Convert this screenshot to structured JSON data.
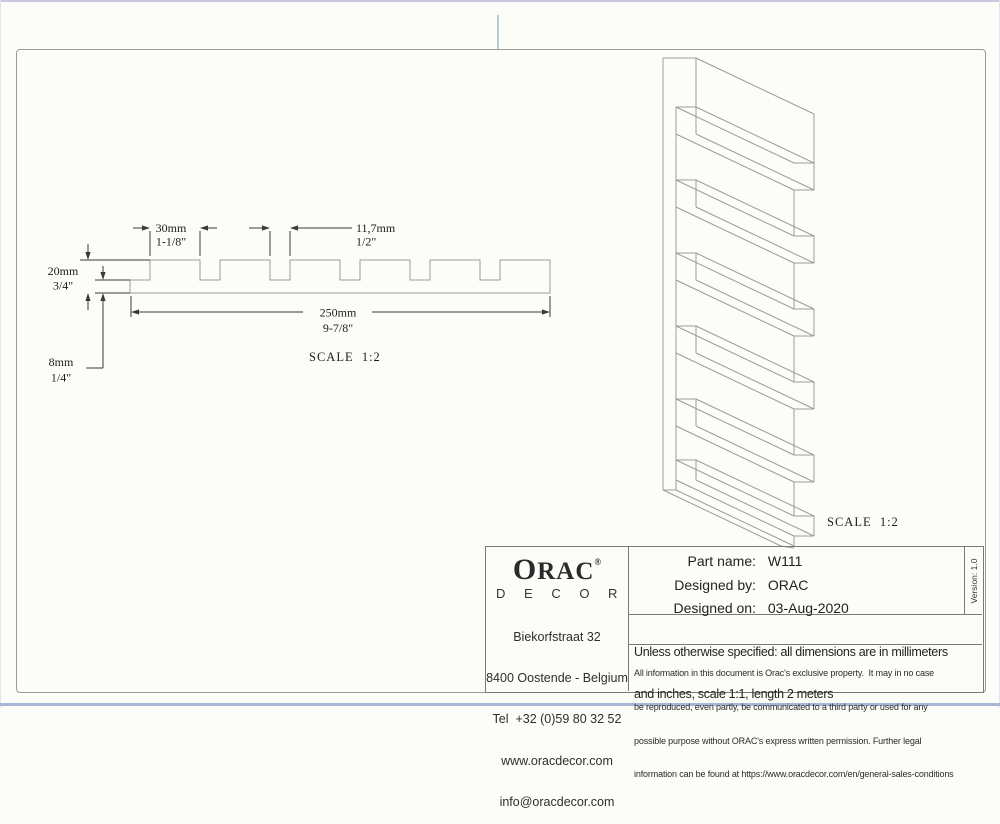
{
  "page": {
    "background": "#fcfcf8",
    "frame_color": "#9a9a9a",
    "top_edge_color": "#c9c6de",
    "bottom_edge_color": "#aab6d8",
    "tick_color": "#b7cdd1",
    "drawing_line_color": "#9b9b9b",
    "dimension_color": "#3a3a3a"
  },
  "drawing": {
    "dims": {
      "slat_width": {
        "mm": "30mm",
        "inch": "1-1/8\""
      },
      "groove_width": {
        "mm": "11,7mm",
        "inch": "1/2\""
      },
      "total_height": {
        "mm": "20mm",
        "inch": "3/4\""
      },
      "base_thickness": {
        "mm": "8mm",
        "inch": "1/4\""
      },
      "total_width": {
        "mm": "250mm",
        "inch": "9-7/8\""
      }
    },
    "scale_left": "SCALE  1:2",
    "scale_right": "SCALE  1:2"
  },
  "title_block": {
    "logo": {
      "name_start": "O",
      "name_rest": "RAC",
      "registered": "®",
      "subname": "D E C O R"
    },
    "address": {
      "line1": "Biekorfstraat 32",
      "line2": "8400 Oostende - Belgium",
      "line3": "Tel  +32 (0)59 80 32 52",
      "line4": "www.oracdecor.com",
      "line5": "info@oracdecor.com"
    },
    "fields": [
      {
        "label": "Part name:",
        "value": "W111"
      },
      {
        "label": "Designed by:",
        "value": "ORAC"
      },
      {
        "label": "Designed on:",
        "value": "03-Aug-2020"
      }
    ],
    "version": "Version: 1.0",
    "note_line1": "Unless otherwise specified: all dimensions are in millimeters",
    "note_line2": "and inches, scale 1:1, length 2 meters",
    "legal": {
      "line1": "All information in this document is Orac's exclusive property.  It may in no case",
      "line2": "be reproduced, even partly, be communicated to a third party or used for any",
      "line3": "possible purpose without ORAC's express written permission. Further legal",
      "line4": "information can be found at https://www.oracdecor.com/en/general-sales-conditions"
    }
  }
}
